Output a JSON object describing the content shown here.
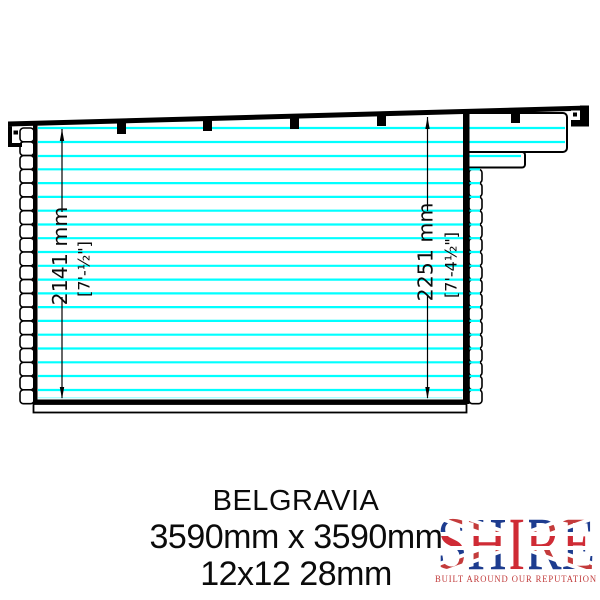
{
  "drawing": {
    "title": "side elevation of log cabin",
    "dim_left_mm": "2141 mm",
    "dim_left_ft": "[7'-½\"]",
    "dim_right_mm": "2251 mm",
    "dim_right_ft": "[7'-4½\"]",
    "line_color": "#00ffff",
    "outline_color": "#000000"
  },
  "caption": {
    "product_name": "BELGRAVIA",
    "dimensions": "3590mm x 3590mm",
    "spec": "12x12 28mm"
  },
  "logo": {
    "brand": "SHIRE",
    "tagline": "BUILT AROUND OUR REPUTATION",
    "tagline_color": "#c13a3a",
    "flag_blue": "#1d3c8f",
    "flag_red": "#cf2b35"
  }
}
